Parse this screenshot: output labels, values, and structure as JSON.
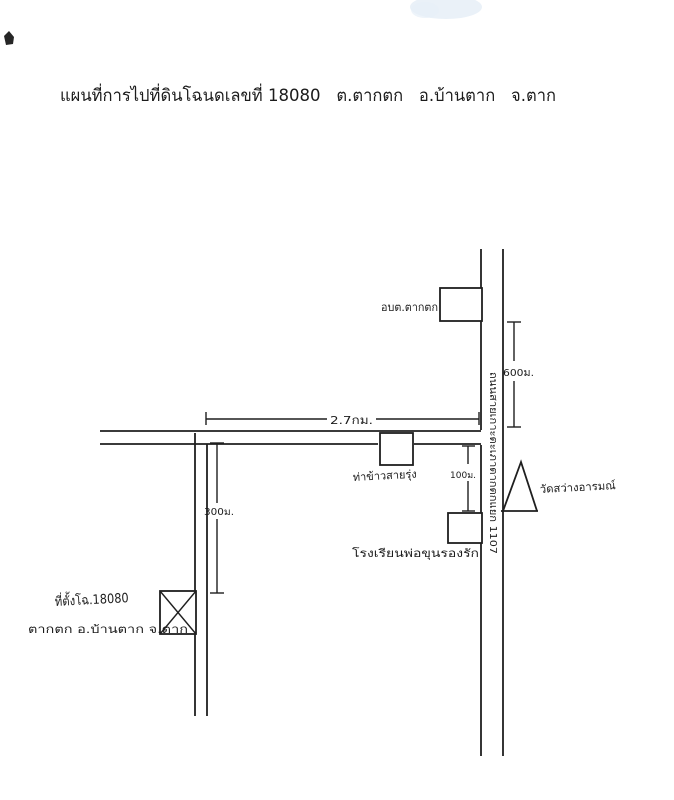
{
  "document": {
    "title": "แผนที่การไปที่ดินโฉนดเลขที่ 18080   ต.ตากตก   อ.บ้านตาก   จ.ตาก"
  },
  "map": {
    "ink_color": "#1f1f1f",
    "places": {
      "sao_office": "อบต.ตากตก",
      "rice_station": "ท่าข้าวสายรุ่ง",
      "school": "โรงเรียนพ่อขุนรองรัก",
      "temple": "วัดสว่างอารมณ์",
      "road_name": "ถนนสายเกาะตะเภาตากตกแยก 1107",
      "site_title": "ที่ตั้งโฉ.18080",
      "site_subtitle": "ตากตก อ.บ้านตาก จ.ตาก"
    },
    "distances": {
      "north_segment": "600ม.",
      "west_segment": "2.7กม.",
      "spur_segment": "100ม.",
      "south_segment": "300ม."
    }
  }
}
